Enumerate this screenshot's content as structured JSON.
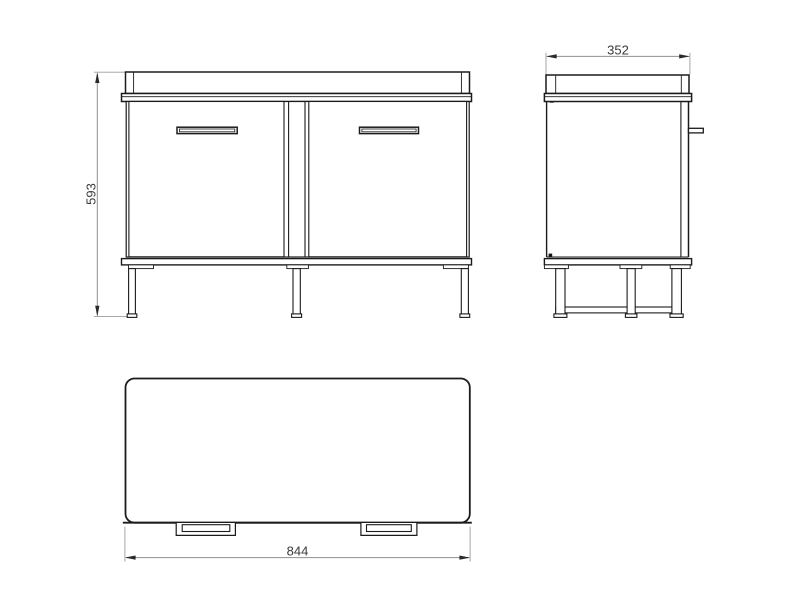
{
  "dimensions": {
    "height": "593",
    "depth": "352",
    "width": "844"
  },
  "style_colors": {
    "object_line": "#1b1b1b",
    "dimension_line": "#8f8f8f",
    "extension_line": "#9c9c9c",
    "arrow": "#2a2a2a",
    "dimension_text": "#3a3a3a",
    "background": "#ffffff"
  }
}
